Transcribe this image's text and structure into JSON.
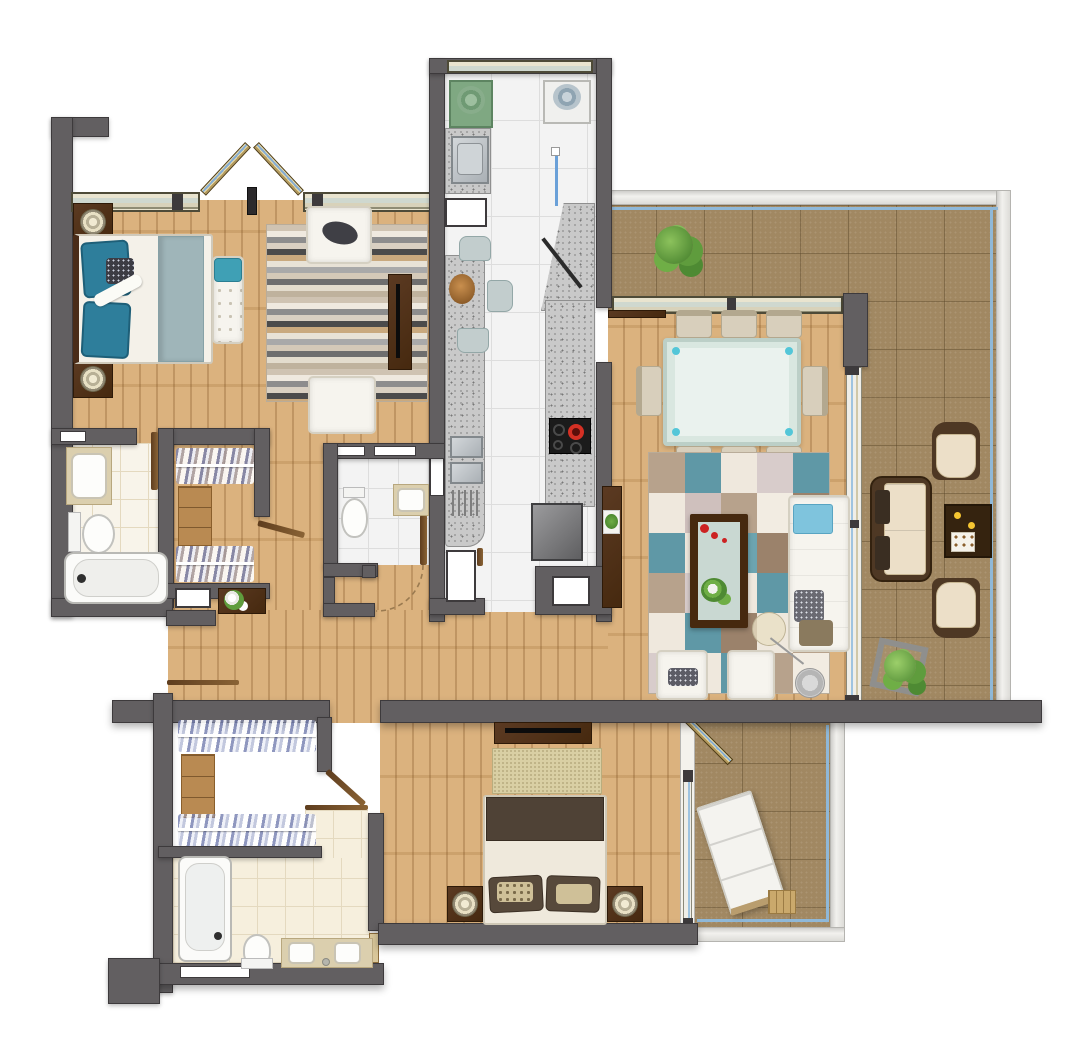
{
  "app": {
    "type": "architectural-floor-plan",
    "view": "top-down-3d-render",
    "text_labels": "none"
  },
  "palette": {
    "wall": "#625f61",
    "wall_outline": "#3d3a3c",
    "wood_floor": "#d9ae77",
    "kitchen_tile": "#f3f3f3",
    "bath_tile": "#f6efdd",
    "terrace_tile": "#a18862",
    "window_frame": "#4e4b38",
    "window_glass": "#cfd8cf",
    "railing_glass_blue": "#8fb8d8",
    "dark_wood_furniture": "#4c2f1a",
    "white_upholstery": "#f6f4ee",
    "teal_accent": "#2e7e9b",
    "rug_teal": "#5f98a6",
    "cream_cushion": "#ecdfc8",
    "granite": "#c9c9c9",
    "appliance_green": "#7fa882",
    "burner_red": "#d43024",
    "candle_yellow": "#f5c531",
    "plant_green": "#5f9c3d",
    "blanket_blue": "#9fb5b9"
  },
  "rooms": [
    {
      "id": "master-bedroom",
      "furniture": [
        "double-bed",
        "teal-pillows",
        "patterned-pillow",
        "blue-runner-blanket",
        "bench",
        "nightstand-left",
        "nightstand-right",
        "table-lamps"
      ]
    },
    {
      "id": "sitting-area",
      "furniture": [
        "striped-rug",
        "armchair-top",
        "armchair-bottom",
        "tv-console"
      ]
    },
    {
      "id": "kitchen",
      "furniture": [
        "green-washer",
        "white-washer",
        "counter-sink",
        "glass-partition",
        "angled-counter",
        "breakfast-bar",
        "fruit-bowl",
        "bar-stools-x3",
        "double-sink",
        "dish-rack",
        "cooktop",
        "island-block"
      ]
    },
    {
      "id": "bathroom-1",
      "furniture": [
        "vanity-sink",
        "toilet",
        "bathtub"
      ]
    },
    {
      "id": "walk-in-closet-1",
      "furniture": [
        "clothes-rail-top",
        "shelf-unit",
        "clothes-rail-bottom",
        "console-with-flowers"
      ]
    },
    {
      "id": "bathroom-2",
      "furniture": [
        "toilet",
        "wall-sink",
        "door-leaf",
        "swing-arc"
      ]
    },
    {
      "id": "living-dining-room",
      "furniture": [
        "dining-table-glass",
        "dining-chairs-x8",
        "checker-rug",
        "coffee-table-glass",
        "red-flowers",
        "white-sofa",
        "blue-towel",
        "armchair-left",
        "armchair-right",
        "floor-lamp",
        "tv-cabinet",
        "wall-shelf"
      ]
    },
    {
      "id": "terrace-main",
      "furniture": [
        "potted-plant-large",
        "loveseat",
        "lounge-chair-top",
        "lounge-chair-bottom",
        "coffee-table-candles",
        "tray",
        "potted-plant-square"
      ]
    },
    {
      "id": "bedroom-2",
      "furniture": [
        "tv-console",
        "beige-rug",
        "double-bed",
        "brown-pillows",
        "nightstand-left",
        "nightstand-right",
        "table-lamps"
      ]
    },
    {
      "id": "walk-in-closet-2",
      "furniture": [
        "clothes-rail-top",
        "shelf-unit",
        "clothes-rail-bottom"
      ]
    },
    {
      "id": "bathroom-3",
      "furniture": [
        "bathtub",
        "toilet",
        "double-vanity"
      ]
    },
    {
      "id": "terrace-bedroom",
      "furniture": [
        "sun-lounger",
        "side-table",
        "open-glass-door"
      ]
    },
    {
      "id": "hallway",
      "furniture": [
        "door-leaves",
        "lintels"
      ]
    }
  ],
  "counts": {
    "dining_chairs": 8,
    "bar_stools": 3,
    "terrace_lounge_chairs": 2,
    "bathrooms": 3,
    "bedrooms": 2,
    "walk_in_closets": 2,
    "terraces": 2
  },
  "rugs": {
    "living_checker": {
      "cols": 5,
      "rows": 6,
      "colors": [
        [
          "#b7a28c",
          "#5f98a6",
          "#efe8dd",
          "#d8cccb",
          "#5f98a6"
        ],
        [
          "#efe8dd",
          "#cfc0bd",
          "#b7a28c",
          "#f2ece2",
          "#9b826b"
        ],
        [
          "#5f98a6",
          "#efe8dd",
          "#6ca4b0",
          "#9b826b",
          "#e7dfd3"
        ],
        [
          "#b7a28c",
          "#d8cccb",
          "#efe8dd",
          "#5f98a6",
          "#cfc0bd"
        ],
        [
          "#efe8dd",
          "#5f98a6",
          "#9b826b",
          "#efe8dd",
          "#b7a28c"
        ],
        [
          "#d8cccb",
          "#efe8dd",
          "#5f98a6",
          "#b7a28c",
          "#f2ece2"
        ]
      ]
    },
    "master_stripes": {
      "stripe_h": 6,
      "colors": [
        "#cfc3b2",
        "#efe9df",
        "#8d8d8d",
        "#d9d0c2",
        "#4b4b4b",
        "#c9a97e",
        "#e8e2d6",
        "#a9a9a9",
        "#d4c9b8",
        "#6e6e6e",
        "#e3dccd",
        "#bfb29d"
      ]
    },
    "bedroom2_rug_color": "#d9cfa4"
  }
}
